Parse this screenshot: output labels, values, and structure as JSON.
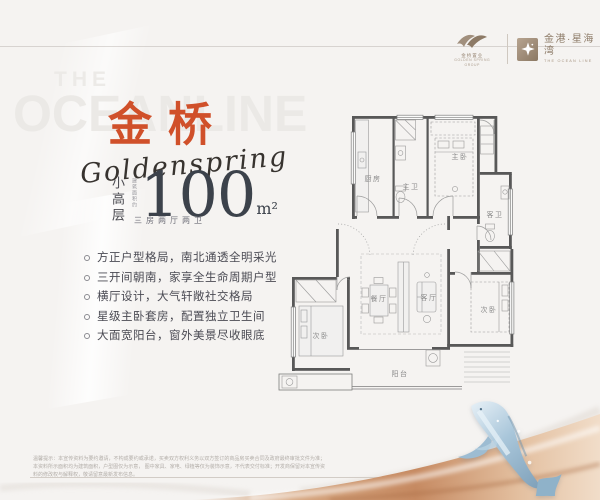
{
  "brand": {
    "name_cn": "金桥",
    "name_script": "Goldenspring"
  },
  "watermark": {
    "line1": "THE",
    "line2": "OCEANLINE"
  },
  "partners": {
    "left": {
      "icon": "bird-logo-icon",
      "line1": "金桥置业",
      "line2": "GOLDEN SPRING GROUP"
    },
    "right": {
      "icon": "star-logo-icon",
      "name": "金港·星海湾",
      "subtitle": "THE OCEAN LINE"
    }
  },
  "headline": {
    "type_vertical": "小高层",
    "area_label_vertical": "建筑面积约",
    "area_value": "100",
    "area_unit": "m²",
    "layout_subtitle": "三房两厅两卫"
  },
  "features": [
    "方正户型格局，南北通透全明采光",
    "三开间朝南，家享全生命周期户型",
    "横厅设计，大气轩敞社交格局",
    "星级主卧套房，配置独立卫生间",
    "大面宽阳台，窗外美景尽收眼底"
  ],
  "floorplan": {
    "rooms": {
      "kitchen": "厨房",
      "master_bath": "主卫",
      "master_bedroom": "主卧",
      "guest_bath": "客卫",
      "dining": "餐厅",
      "living": "客厅",
      "bedroom_left": "次卧",
      "bedroom_right": "次卧",
      "balcony": "阳台"
    }
  },
  "disclaimer": {
    "line1": "温馨提示：本宣传资料为要约邀请，不构成要约或承诺，买卖双方权利义务以双方签订的商品房买卖合同及政府最终审批文件为准；本资料所示面积均为建筑面积，户型图仅为示意，",
    "line2": "图中家具、家电、绿植等仅为装饰示意，不代表交付标准；开发商保留对本宣传资料的修改权与解释权，敬请留意最新发布信息。"
  },
  "colors": {
    "accent_orange": "#d0502a",
    "taupe": "#9a8774",
    "copper": "#c98f69",
    "plan_wall": "#585858",
    "whale_blue": "#9fbdd4"
  }
}
